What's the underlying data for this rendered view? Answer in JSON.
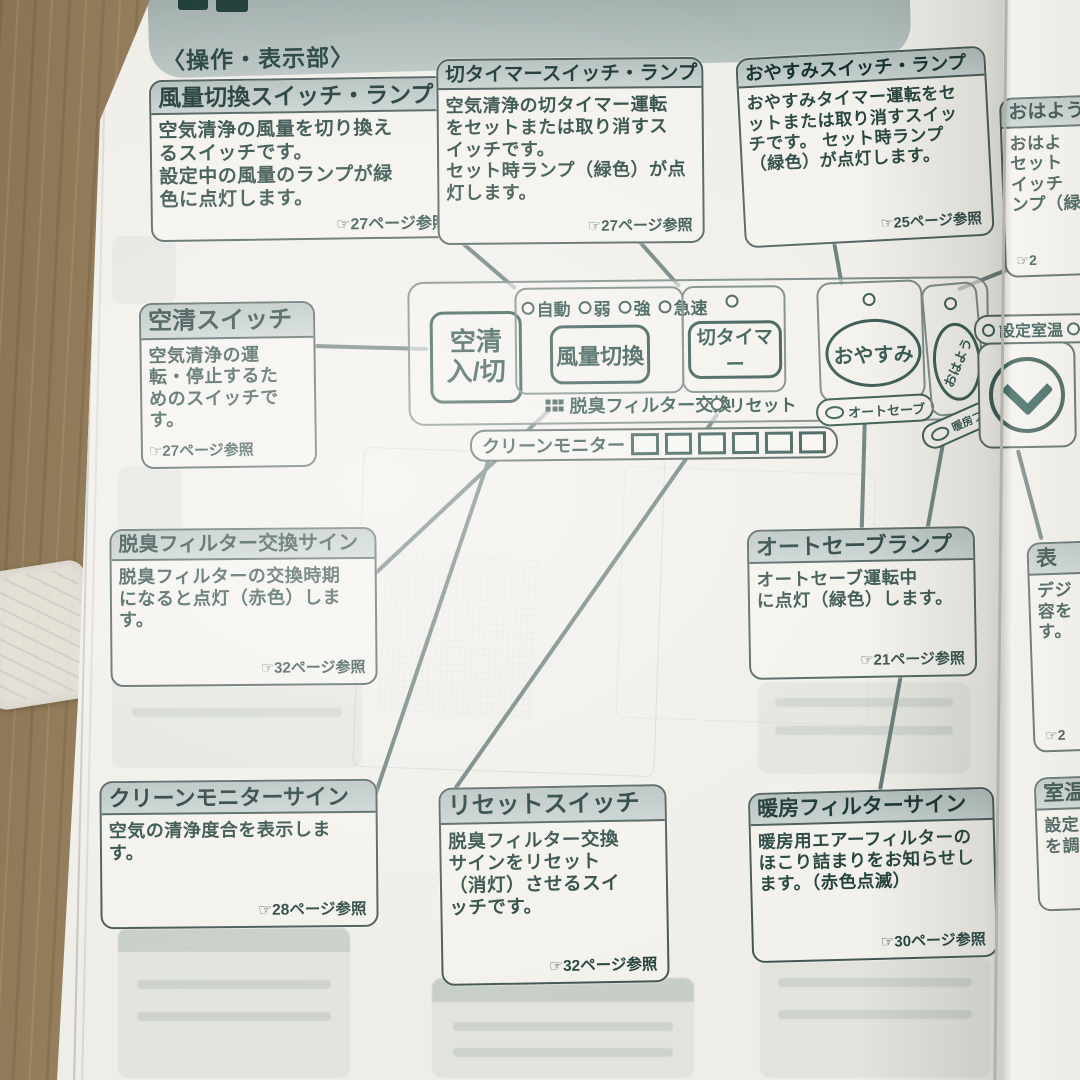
{
  "header": {
    "section_heading": "〈操作・表示部〉"
  },
  "callouts": {
    "fan_switch": {
      "title": "風量切換スイッチ・ランプ",
      "body": "空気清浄の風量を切り換え\nるスイッチです。\n設定中の風量のランプが緑\n色に点灯します。",
      "ref": "☞27ページ参照"
    },
    "off_timer": {
      "title": "切タイマースイッチ・ランプ",
      "body": "空気清浄の切タイマー運転\nをセットまたは取り消すス\nイッチです。\nセット時ランプ（緑色）が点\n灯します。",
      "ref": "☞27ページ参照"
    },
    "oyasumi": {
      "title": "おやすみスイッチ・ランプ",
      "body": "おやすみタイマー運転をセ\nットまたは取り消すスイッ\nチです。 セット時ランプ\n（緑色）が点灯します。",
      "ref": "☞25ページ参照"
    },
    "ohayou_cut": {
      "title": "おはよう",
      "body": "おはよ\nセット\nイッチ\nンプ（緑",
      "ref": "☞2"
    },
    "kusei": {
      "title": "空清スイッチ",
      "body": "空気清浄の運\n転・停止するた\nめのスイッチで\nす。",
      "ref": "☞27ページ参照"
    },
    "filter_sign": {
      "title": "脱臭フィルター交換サイン",
      "body": "脱臭フィルターの交換時期\nになると点灯（赤色）しま\nす。",
      "ref": "☞32ページ参照"
    },
    "autosave_lamp": {
      "title": "オートセーブランプ",
      "body": "オートセーブ運転中\nに点灯（緑色）します。",
      "ref": "☞21ページ参照"
    },
    "display_cut": {
      "title": "表",
      "body": "デジ\n容を\nす。",
      "ref": "☞2"
    },
    "clean_monitor": {
      "title": "クリーンモニターサイン",
      "body": "空気の清浄度合を表示しま\nす。",
      "ref": "☞28ページ参照"
    },
    "reset_switch": {
      "title": "リセットスイッチ",
      "body": "脱臭フィルター交換\nサインをリセット\n（消灯）させるスイ\nッチです。",
      "ref": "☞32ページ参照"
    },
    "danbou_filter": {
      "title": "暖房フィルターサイン",
      "body": "暖房用エアーフィルターの\nほこり詰まりをお知らせし\nます。（赤色点滅）",
      "ref": "☞30ページ参照"
    },
    "shitsuon_cut": {
      "title": "室温",
      "body": "設定\nを調"
    }
  },
  "panel": {
    "power_button": "空清\n入/切",
    "fan_lamps": [
      "自動",
      "弱",
      "強",
      "急速"
    ],
    "fan_button": "風量切換",
    "timer_button": "切タイマー",
    "deodorize_label": "脱臭フィルター交換",
    "reset_label": "リセット",
    "clean_monitor_label": "クリーンモニター",
    "oyasumi_button": "おやすみ",
    "autosave_pill": "オートセーブ",
    "ohayou_button": "おはよう",
    "heater_pill": "暖房フィルター",
    "set_temp_label": "設定室温"
  },
  "colors": {
    "text": "#24423d",
    "title_bar": "#b9c5c3",
    "page": "#efede7",
    "wood": "#967f5e",
    "line": "#5e7370"
  }
}
